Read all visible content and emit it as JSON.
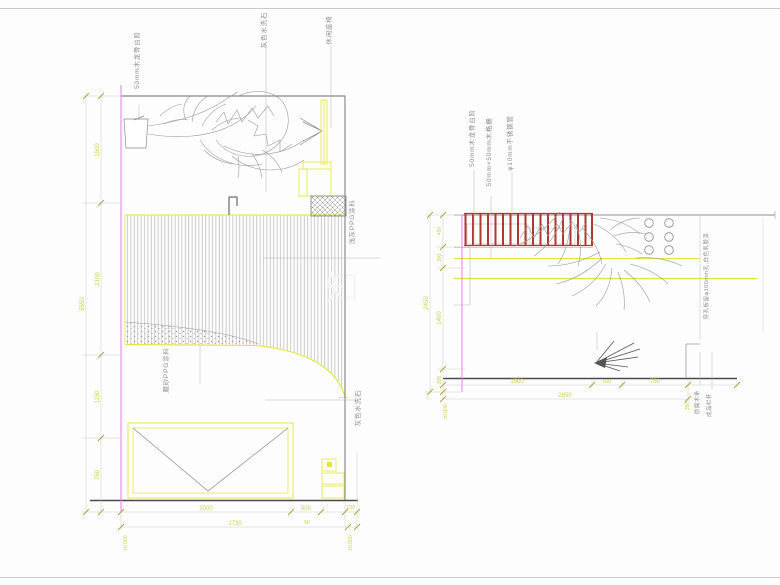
{
  "page": {
    "type": "CAD elevation drawing",
    "background": "#fdfdfd"
  },
  "colors": {
    "dim_yellow": "#cfcf4a",
    "line_yellow": "#e6e62e",
    "magenta": "#e87ee8",
    "fence_red": "#b03830",
    "outline_gray": "#606060",
    "sketch_gray": "#9a9a9a"
  },
  "left": {
    "callouts": {
      "step": "50mm木龙骨台阶",
      "washed_stone": "灰色水洗石",
      "bench": "休闲座椅",
      "ppg_light": "浅灰PPG涂料",
      "ppg_matte": "磨砂PPG涂料",
      "washed_stone2": "灰色水洗石"
    },
    "dims": {
      "left": [
        "1500",
        "2100",
        "1150",
        "750"
      ],
      "left_overall": "5550",
      "bottom1": [
        "2000",
        "500",
        "230"
      ],
      "bottom2": [
        "2730",
        "50"
      ],
      "level_left": "±0.000",
      "level_right": "±0.000"
    }
  },
  "right": {
    "callouts": {
      "step": "50mm木龙骨台阶",
      "grille": "50mm×50mm木格栅",
      "pipe": "φ10mm不锈钢管",
      "perforated": "穿孔板留φ100mm孔,白色乳胶漆",
      "wood_strip": "防腐木条",
      "handrail": "成品栏杆"
    },
    "dims": {
      "left": [
        "450",
        "300",
        "1400",
        "300"
      ],
      "left_overall": "2450",
      "bottom1": [
        "1500",
        "600",
        "750"
      ],
      "bottom_overall": "2850",
      "step_height": "350",
      "level_left": "±0.000"
    }
  },
  "watermark": {
    "glyph": "知"
  }
}
